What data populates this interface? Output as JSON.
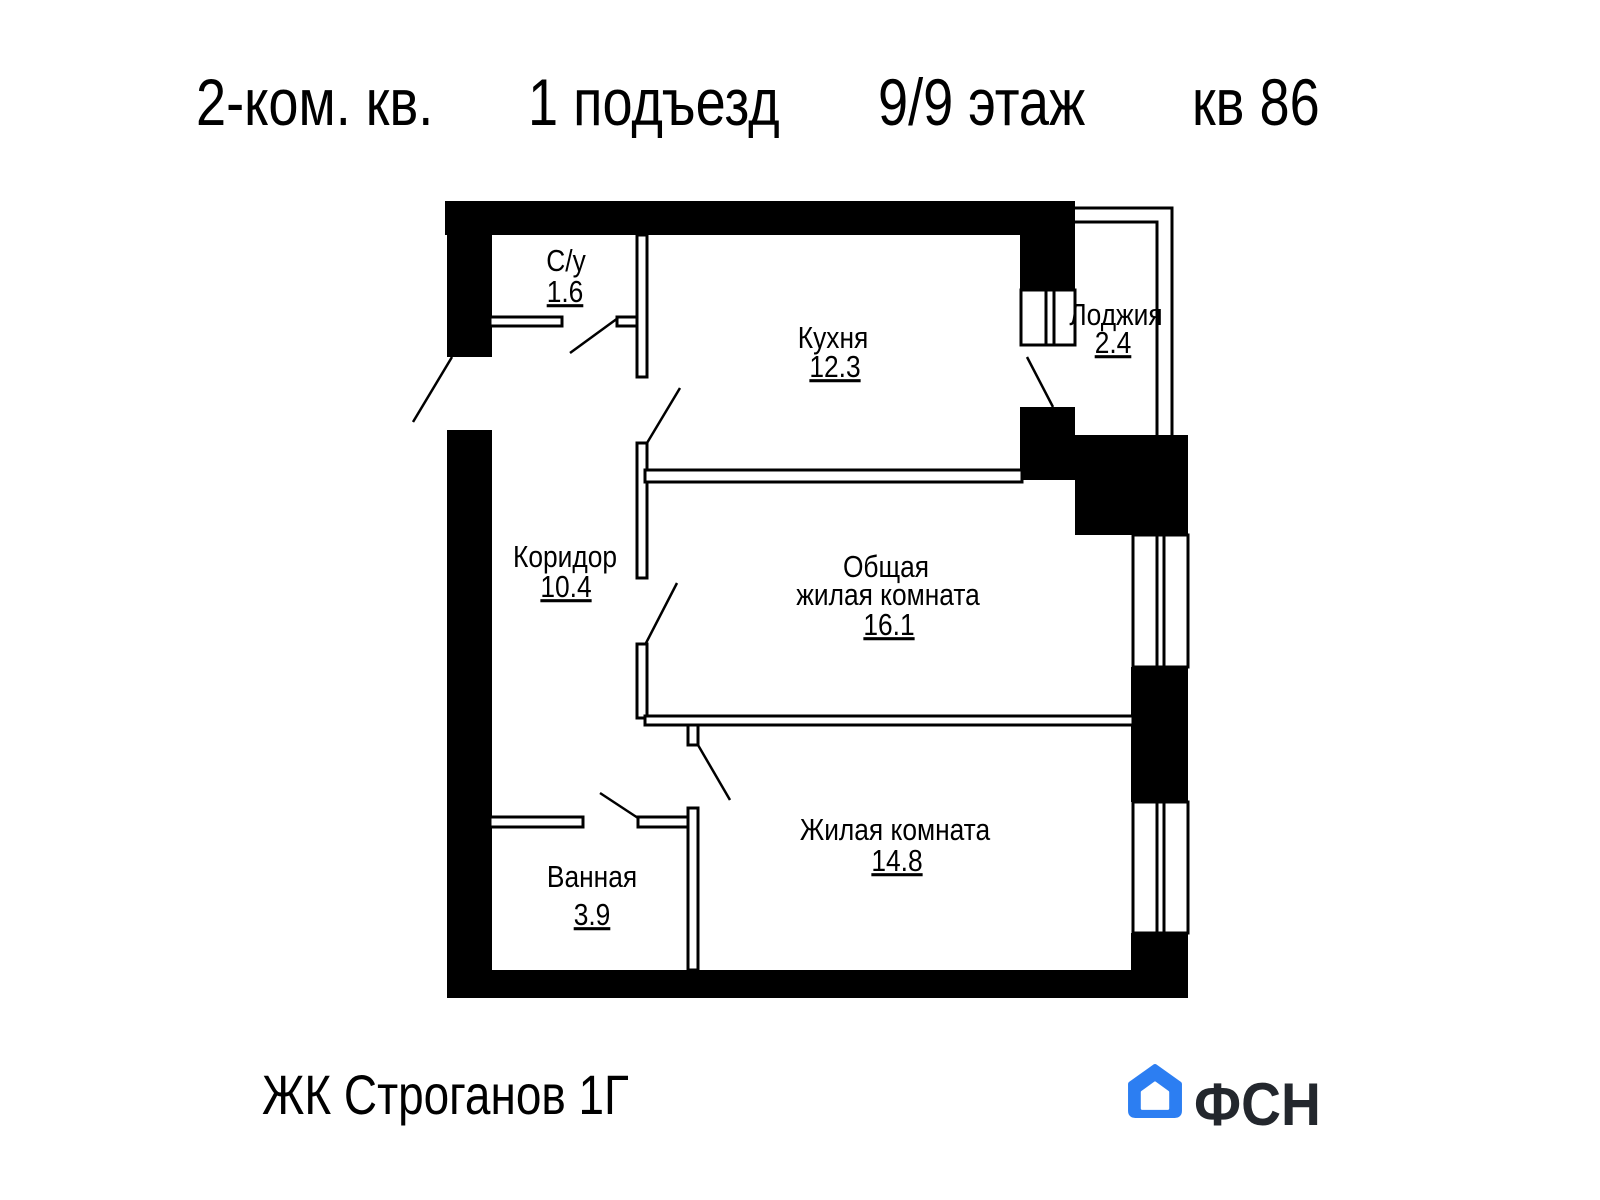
{
  "header": {
    "apartment_type": "2-ком. кв.",
    "entrance": "1 подъезд",
    "floor": "9/9 этаж",
    "unit": "кв 86"
  },
  "rooms": {
    "su": {
      "label": "С/у",
      "area": "1.6"
    },
    "kitchen": {
      "label": "Кухня",
      "area": "12.3"
    },
    "loggia": {
      "label": "Лоджия",
      "area": "2.4"
    },
    "corridor": {
      "label": "Коридор",
      "area": "10.4"
    },
    "living_common": {
      "label_line1": "Общая",
      "label_line2": "жилая комната",
      "area": "16.1"
    },
    "bathroom": {
      "label": "Ванная",
      "area": "3.9"
    },
    "living": {
      "label": "Жилая комната",
      "area": "14.8"
    }
  },
  "footer": {
    "project": "ЖК Строганов 1Г",
    "brand": "ФСН",
    "logo_icon": "house"
  },
  "colors": {
    "brand_blue": "#2C7EF2",
    "logo_text": "#23272D",
    "plan_ink": "#000000"
  }
}
